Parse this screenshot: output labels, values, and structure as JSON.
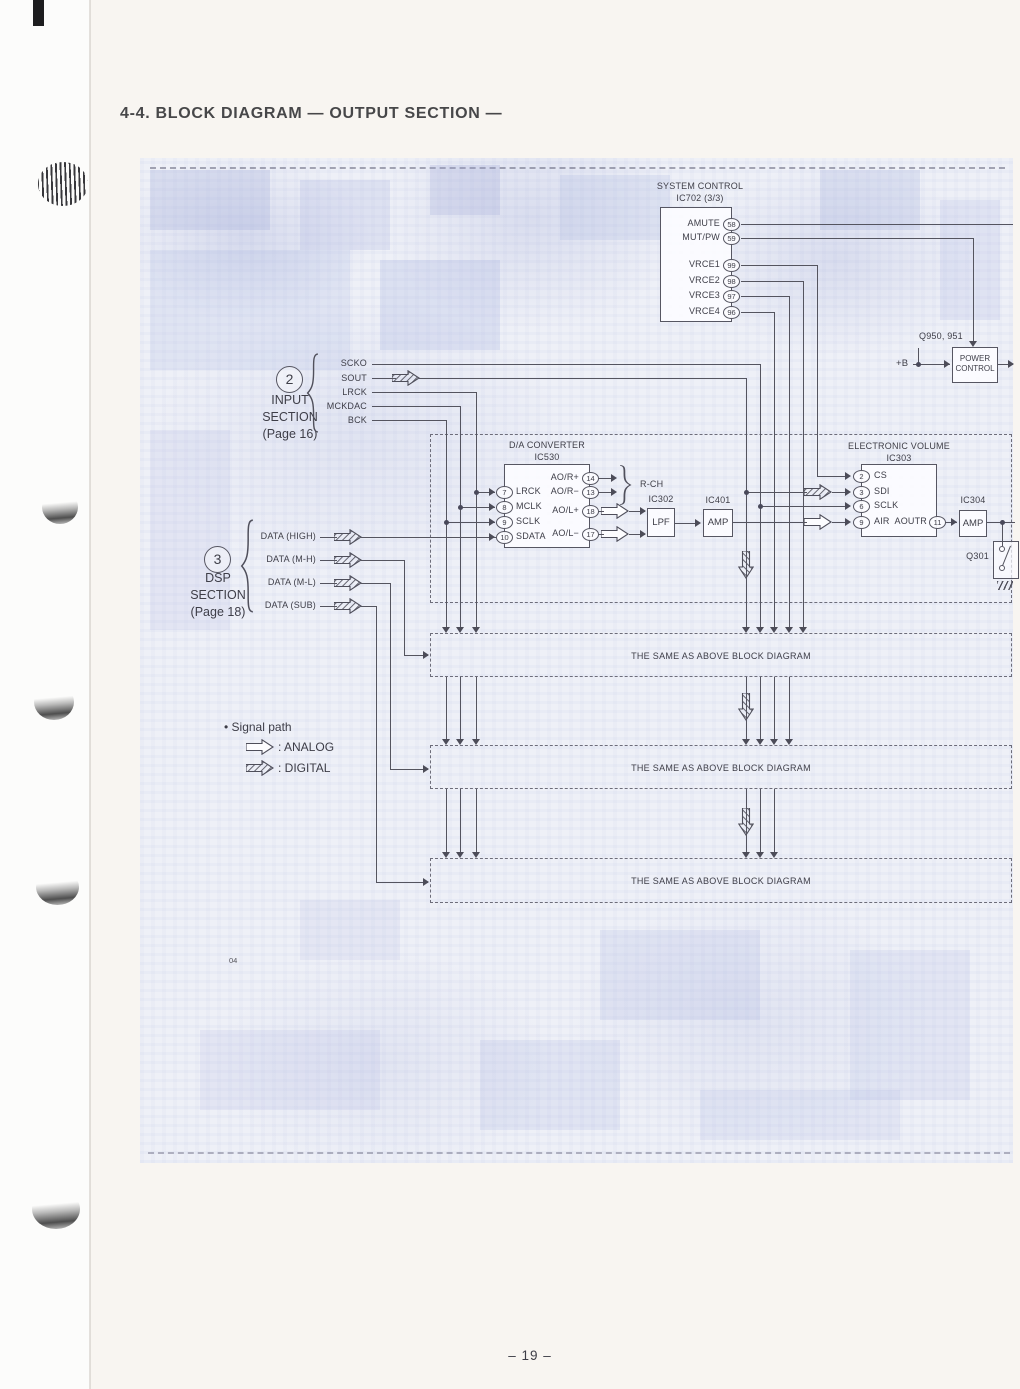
{
  "page": {
    "title": "4-4. BLOCK DIAGRAM — OUTPUT SECTION —",
    "page_number": "– 19 –",
    "footnote": "04"
  },
  "system_control": {
    "title": "SYSTEM CONTROL",
    "subtitle": "IC702 (3/3)",
    "pins": [
      {
        "label": "AMUTE",
        "num": "58"
      },
      {
        "label": "MUT/PW",
        "num": "59"
      },
      {
        "label": "VRCE1",
        "num": "99"
      },
      {
        "label": "VRCE2",
        "num": "98"
      },
      {
        "label": "VRCE3",
        "num": "97"
      },
      {
        "label": "VRCE4",
        "num": "96"
      }
    ]
  },
  "power_control": {
    "ref": "Q950, 951",
    "line1": "POWER",
    "line2": "CONTROL",
    "supply": "+B"
  },
  "input_section": {
    "num": "2",
    "name1": "INPUT",
    "name2": "SECTION",
    "page_ref": "(Page 16)",
    "signals": [
      "SCKO",
      "SOUT",
      "LRCK",
      "MCKDAC",
      "BCK"
    ]
  },
  "dsp_section": {
    "num": "3",
    "name1": "DSP",
    "name2": "SECTION",
    "page_ref": "(Page 18)",
    "signals": [
      "DATA (HIGH)",
      "DATA (M-H)",
      "DATA (M-L)",
      "DATA (SUB)"
    ]
  },
  "dac": {
    "title": "D/A CONVERTER",
    "subtitle": "IC530",
    "left_pins": [
      {
        "num": "7",
        "label": "LRCK"
      },
      {
        "num": "8",
        "label": "MCLK"
      },
      {
        "num": "9",
        "label": "SCLK"
      },
      {
        "num": "10",
        "label": "SDATA"
      }
    ],
    "right_pins": [
      {
        "label": "AO/R+",
        "num": "14"
      },
      {
        "label": "AO/R−",
        "num": "13"
      },
      {
        "label": "AO/L+",
        "num": "18"
      },
      {
        "label": "AO/L−",
        "num": "17"
      }
    ],
    "rch_label": "R-CH"
  },
  "lpf": {
    "ref": "IC302",
    "label": "LPF"
  },
  "amp_r": {
    "ref": "IC401",
    "label": "AMP"
  },
  "evol": {
    "title": "ELECTRONIC VOLUME",
    "subtitle": "IC303",
    "left_pins": [
      {
        "num": "2",
        "label": "CS"
      },
      {
        "num": "3",
        "label": "SDI"
      },
      {
        "num": "6",
        "label": "SCLK"
      },
      {
        "num": "9",
        "label": "AIR"
      }
    ],
    "out_pin": {
      "label": "AOUTR",
      "num": "11"
    }
  },
  "amp_out": {
    "ref": "IC304",
    "label": "AMP"
  },
  "q301": {
    "ref": "Q301"
  },
  "same_as_above": "THE SAME AS ABOVE BLOCK DIAGRAM",
  "legend": {
    "title": "• Signal path",
    "analog": ": ANALOG",
    "digital": ": DIGITAL"
  }
}
